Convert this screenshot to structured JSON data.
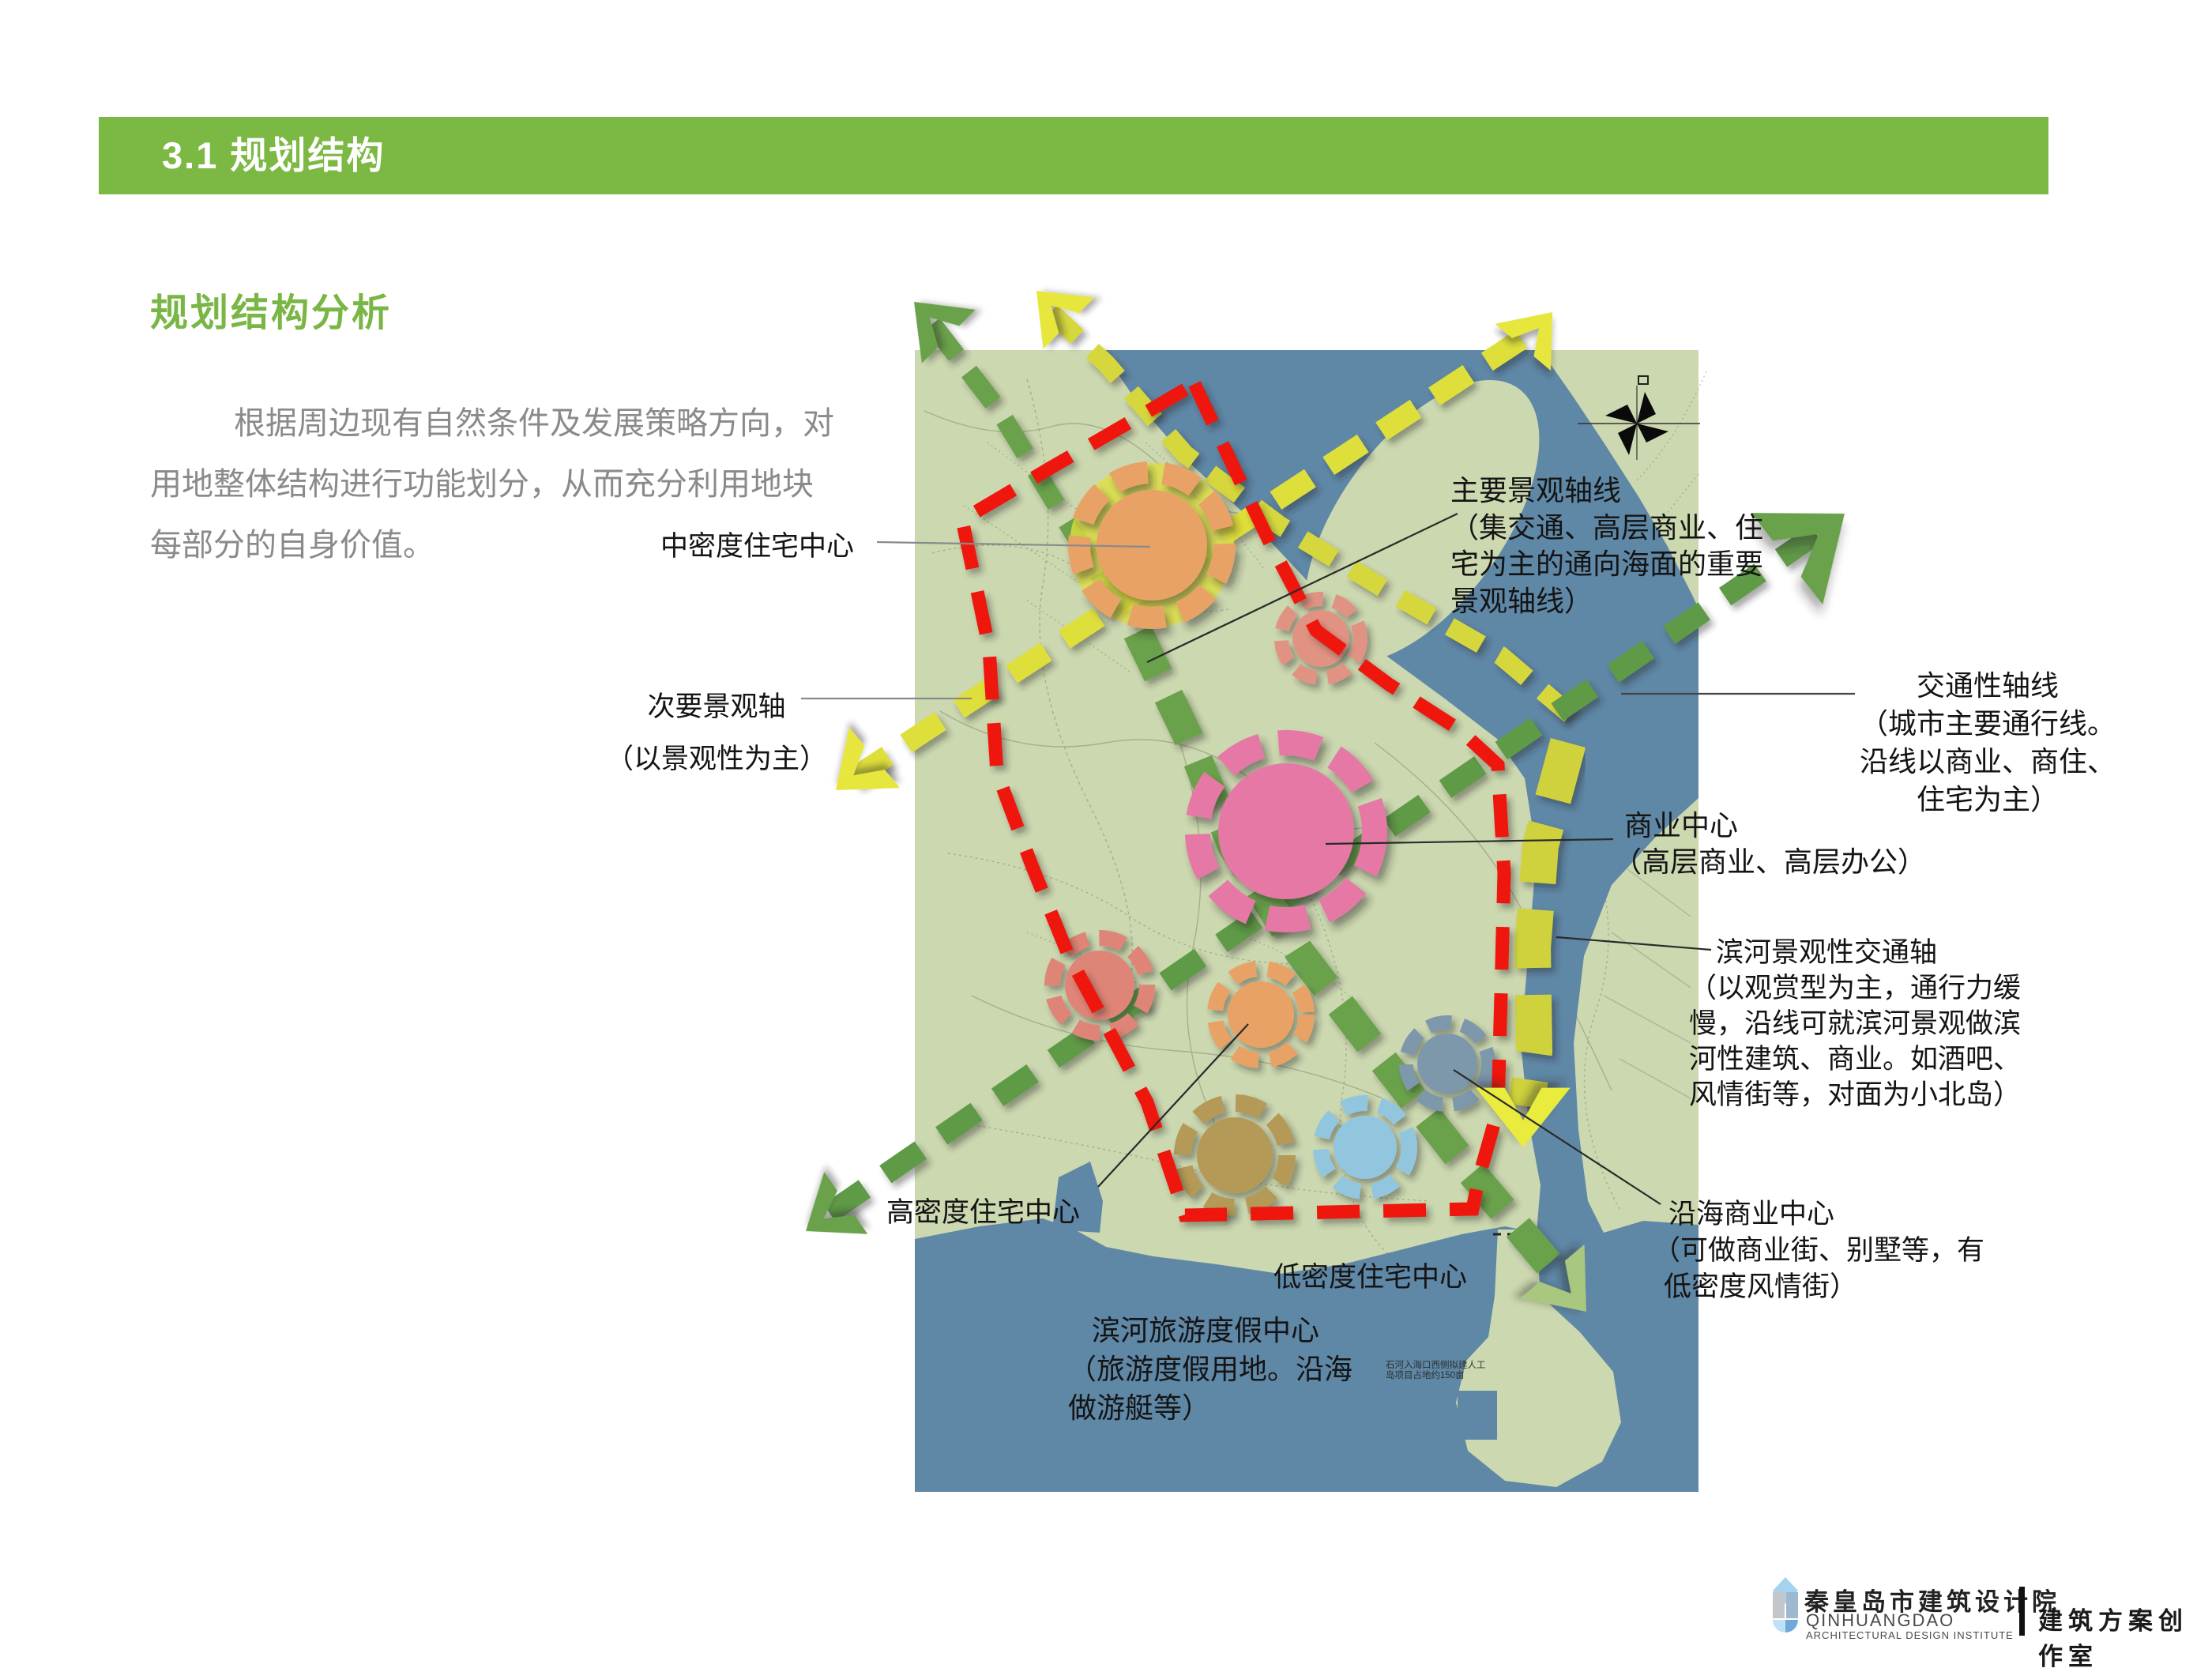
{
  "header": {
    "title": "3.1 规划结构"
  },
  "intro": {
    "title": "规划结构分析",
    "paragraph_lines": [
      "根据周边现有自然条件及发展策略方向，对",
      "用地整体结构进行功能划分，从而充分利用地块",
      "每部分的自身价值。"
    ]
  },
  "map": {
    "annotations": {
      "medium_density": {
        "lines": [
          "中密度住宅中心"
        ]
      },
      "main_axis": {
        "lines": [
          "主要景观轴线",
          "（集交通、高层商业、住",
          "宅为主的通向海面的重要",
          "景观轴线）"
        ]
      },
      "secondary_axis": {
        "lines": [
          "次要景观轴",
          "（以景观性为主）"
        ]
      },
      "traffic_axis": {
        "lines": [
          "交通性轴线",
          "（城市主要通行线。",
          "沿线以商业、商住、",
          "住宅为主）"
        ]
      },
      "commercial_center": {
        "lines": [
          "商业中心",
          "（高层商业、高层办公）"
        ]
      },
      "riverside_axis": {
        "lines": [
          "滨河景观性交通轴",
          "（以观赏型为主，通行力缓",
          "慢，沿线可就滨河景观做滨",
          "河性建筑、商业。如酒吧、",
          "风情街等，对面为小北岛）"
        ]
      },
      "high_density": {
        "lines": [
          "高密度住宅中心"
        ]
      },
      "low_density": {
        "lines": [
          "低密度住宅中心"
        ]
      },
      "riverside_resort": {
        "lines": [
          "滨河旅游度假中心",
          "（旅游度假用地。沿海",
          "做游艇等）"
        ]
      },
      "coastal_commercial": {
        "lines": [
          "沿海商业中心",
          "（可做商业街、别墅等，有",
          "低密度风情街）"
        ]
      },
      "island_note": {
        "lines": [
          "石河入海口西侧拟建人工",
          "岛项目占地约150亩"
        ]
      }
    },
    "colors": {
      "boundary_red": "#ee1511",
      "landscape_axis_yellow": "#dedd3a",
      "traffic_axis_green": "#5f9a47",
      "corridor_green": "#6ba24c",
      "water_blue": "#5f87a6",
      "land_sage": "#ccd8b0",
      "center_medium_density": "#e8a266",
      "center_commercial_pink": "#e678a6",
      "center_mixed_salmon": "#df8577",
      "center_riverside_blue": "#7d98ab",
      "center_khaki": "#b49a57",
      "center_lightblue": "#92c6de"
    }
  },
  "footer": {
    "org_cn": "秦皇岛市建筑设计院",
    "org_en_line1": "QINHUANGDAO",
    "org_en_line2": "ARCHITECTURAL DESIGN INSTITUTE",
    "studio": "建筑方案创作室"
  },
  "theme": {
    "bar_green": "#7cb944",
    "heading_green": "#7ab646",
    "body_gray": "#8a8a8a"
  }
}
